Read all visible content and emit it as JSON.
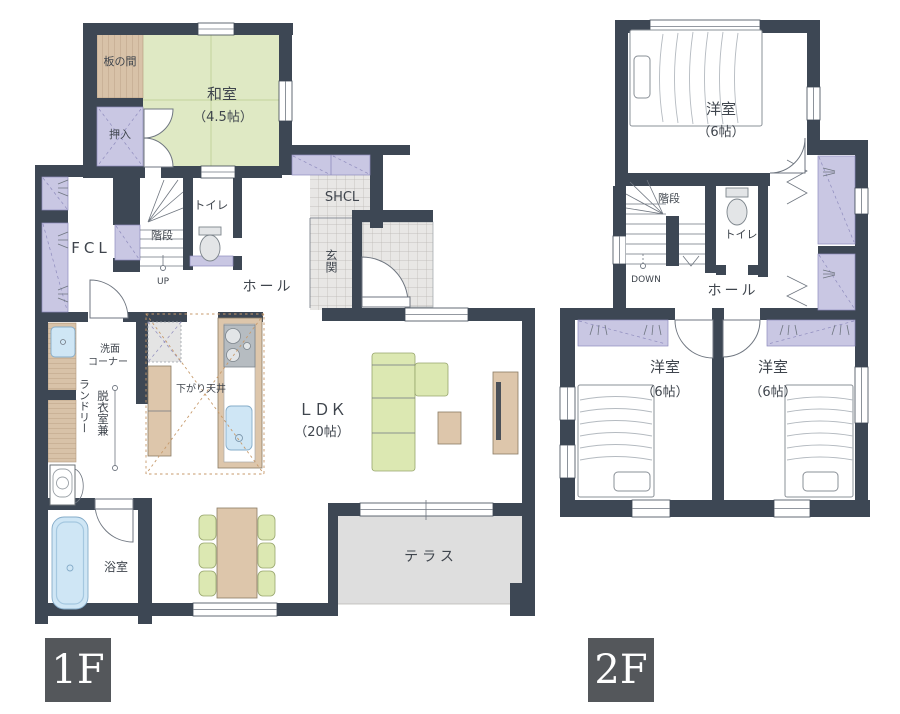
{
  "colors": {
    "wall": "#3d4754",
    "tatami_green": "#dfe9c4",
    "closet_lavender": "#c9c7e3",
    "wood_tan": "#d8c2a8",
    "furniture_tan": "#ddc6ab",
    "sofa_green": "#dce8b2",
    "water_blue": "#cfe6f5",
    "tile_gray": "#e8e7e5",
    "terrace_gray": "#dedede",
    "badge_bg": "#54575b",
    "label_text": "#3f454d"
  },
  "floor1": {
    "badge": "1F",
    "labels": {
      "itanoma": "板の間",
      "washitsu": "和室",
      "washitsu_size": "（4.5帖）",
      "oshiire": "押入",
      "fcl": "FCL",
      "stairs": "階段",
      "up": "UP",
      "toilet": "トイレ",
      "hall": "ホール",
      "shcl": "SHCL",
      "genkan": "玄関",
      "senmen_line1": "洗面",
      "senmen_line2": "コーナー",
      "laundry": "ランドリー",
      "datsui": "脱衣室兼",
      "bath": "浴室",
      "sagari_tenjo": "下がり天井",
      "ldk": "ＬＤＫ",
      "ldk_size": "（20帖）",
      "terrace": "テラス"
    }
  },
  "floor2": {
    "badge": "2F",
    "labels": {
      "yoshitsu": "洋室",
      "yoshitsu_size": "（6帖）",
      "stairs": "階段",
      "down": "DOWN",
      "toilet": "トイレ",
      "hall": "ホール"
    }
  }
}
